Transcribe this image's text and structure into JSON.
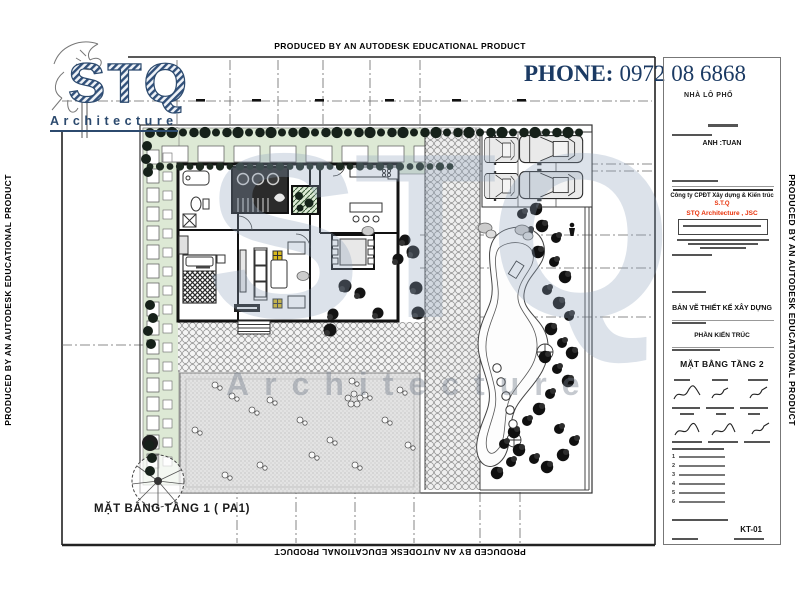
{
  "notice": {
    "autodesk": "PRODUCED BY AN AUTODESK EDUCATIONAL PRODUCT"
  },
  "logo": {
    "letters": "STQ",
    "word": "Architecture"
  },
  "contact": {
    "phone_label": "PHONE:",
    "phone_number": "0972 08 6868",
    "project_type": "NHÀ LÔ PHỐ"
  },
  "watermark": {
    "letters": "STQ",
    "word": "Architecture"
  },
  "plan": {
    "caption": "MẶT BẰNG TẦNG 1 ( PA1)"
  },
  "title_block": {
    "client": "ANH :TUAN",
    "company_vi": "Công ty CPĐT Xây dựng & Kiến trúc",
    "company_short": "S.T.Q",
    "company_en": "STQ Architecture , JSC",
    "doc_type": "BẢN VẼ THIẾT KẾ XÂY DỰNG",
    "discipline": "PHẦN KIẾN TRÚC",
    "drawing_title": "MẶT BẰNG TẦNG 2",
    "note_numbers": [
      "1",
      "2",
      "3",
      "4",
      "5",
      "6"
    ],
    "drawing_no": "KT-01"
  }
}
